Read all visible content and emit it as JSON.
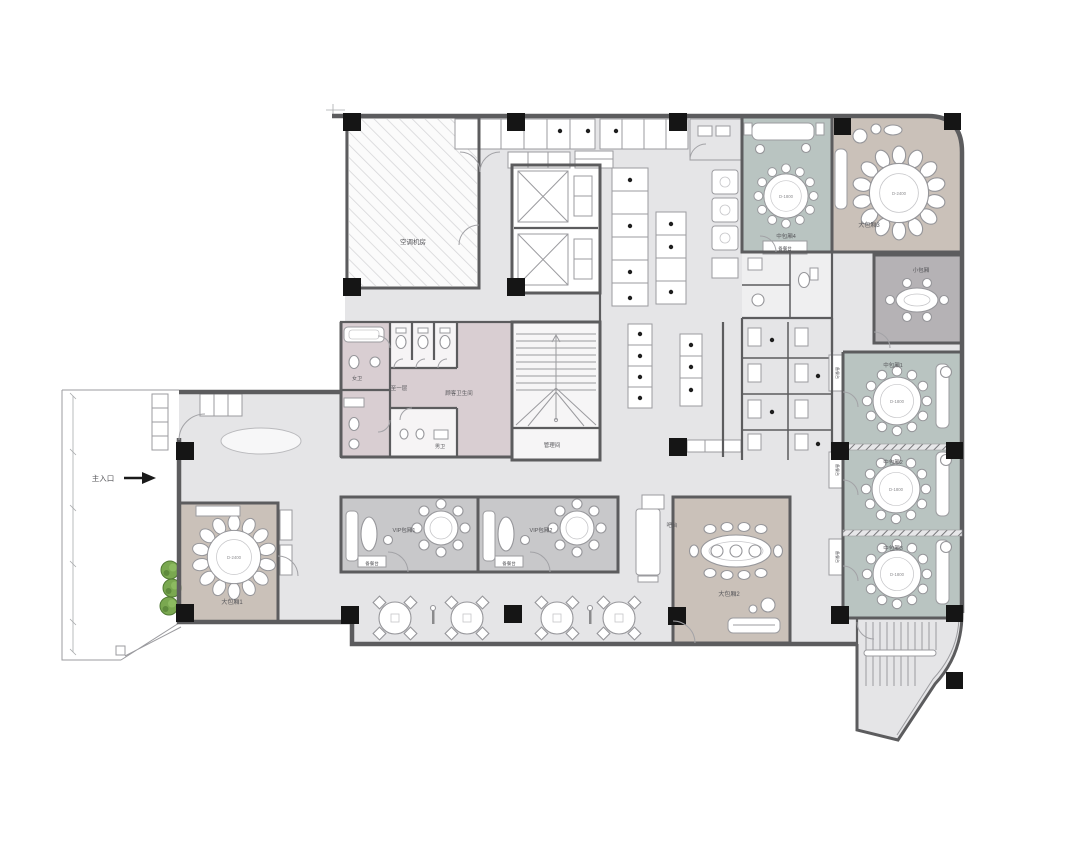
{
  "plan": {
    "entrance": "主入口",
    "ac_room": "空调机房",
    "to_first_floor": "至一层",
    "customer_wc": "顾客卫生间",
    "female_wc": "女卫",
    "male_wc": "男卫",
    "management": "管理间",
    "bar": "吧台",
    "side_station": "备餐台",
    "rooms": {
      "large1": "大包厢1",
      "large2": "大包厢2",
      "large3": "大包厢3",
      "small1": "小包厢",
      "medium1": "中包厢1",
      "medium2": "中包厢2",
      "medium3": "中包厢3",
      "medium4": "中包厢4",
      "vip1": "VIP包厢1",
      "vip2": "VIP包厢2"
    },
    "tables": {
      "d1800": "D-1800",
      "d2400": "D-2400"
    },
    "colors": {
      "floor": "#e5e5e7",
      "wall": "#5c5c5e",
      "teal": "#b9c4c1",
      "brown": "#cac1b9",
      "vip_gray": "#c8c8ca",
      "pink": "#d9ced2",
      "small_gray": "#b5b2b5",
      "plant_green": "#76a84e",
      "column": "#141414"
    }
  }
}
